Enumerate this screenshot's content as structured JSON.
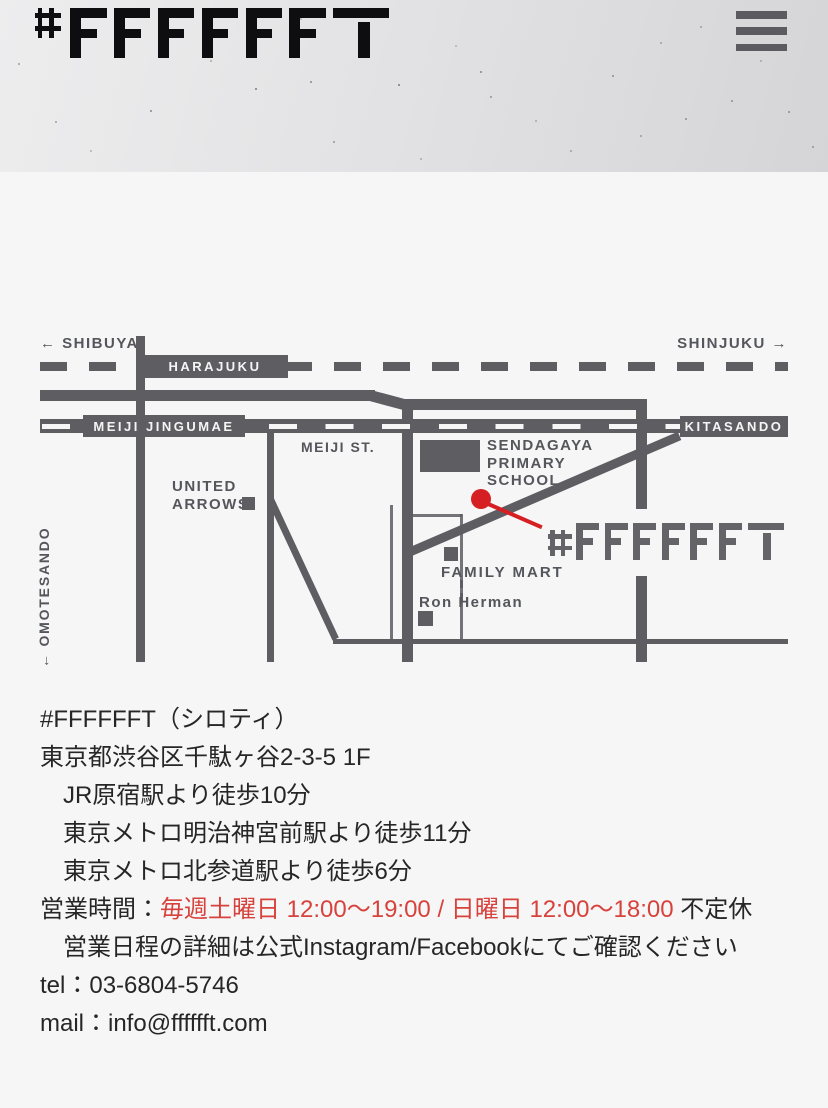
{
  "header": {
    "logo_text": "#FFFFFFT",
    "menu_icon": "hamburger-menu"
  },
  "map": {
    "direction_left": "← SHIBUYA",
    "direction_right": "SHINJUKU →",
    "stations": {
      "harajuku": "HARAJUKU",
      "meiji_jingumae": "MEIJI JINGUMAE",
      "kitasando": "KITASANDO"
    },
    "streets": {
      "meiji_st": "MEIJI ST.",
      "omotesando": "← OMOTESANDO"
    },
    "landmarks": {
      "united_arrows": [
        "UNITED",
        "ARROWS"
      ],
      "sendagaya_primary_school": [
        "SENDAGAYA",
        "PRIMARY",
        "SCHOOL"
      ],
      "family_mart": "FAMILY MART",
      "ron_herman": "Ron Herman"
    },
    "shop_logo_text": "#FFFFFFT"
  },
  "info": {
    "shop_name": "#FFFFFFT（シロティ）",
    "address": "東京都渋谷区千駄ヶ谷2-3-5 1F",
    "access": [
      "JR原宿駅より徒歩10分",
      "東京メトロ明治神宮前駅より徒歩11分",
      "東京メトロ北参道駅より徒歩6分"
    ],
    "hours": {
      "label": "営業時間：",
      "highlight": "毎週土曜日 12:00〜19:00 / 日曜日 12:00〜18:00",
      "suffix": " 不定休",
      "note": "営業日程の詳細は公式Instagram/Facebookにてご確認ください"
    },
    "tel": "tel：03-6804-5746",
    "mail": "mail：info@fffffft.com"
  },
  "colors": {
    "road": "#5d5d62",
    "map_label": "#55565b",
    "station_text": "#f5f5f6",
    "marker_red": "#d51f22",
    "text_red": "#d7423c",
    "ink": "#262626",
    "logo_black": "#0e0e10",
    "map_logo_gray": "#636368",
    "page_bg": "#f6f6f7",
    "header_light": "#ededee",
    "header_dark": "#d5d5d8",
    "menu_bar": "#5b5b60"
  }
}
